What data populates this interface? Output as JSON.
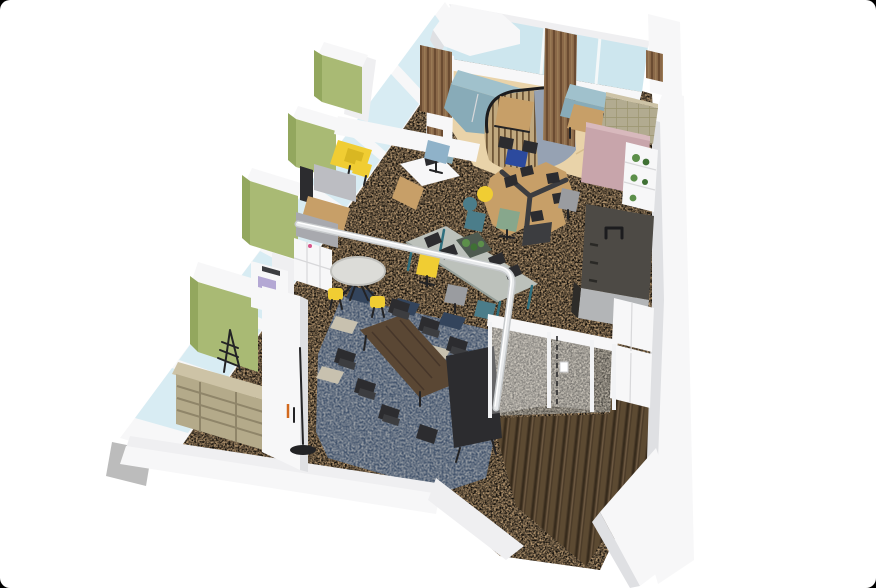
{
  "meta": {
    "title": "3D isometric office floor plan rendering",
    "type": "architectural-render",
    "canvas": {
      "width": 876,
      "height": 588,
      "corner_radius": 10,
      "background": "#ffffff",
      "corner_background": "#000000"
    },
    "description": "Bird's-eye isometric render of an office: window walls on two sides, lounge with curved slatted pod, open office desks on tan carpet, meeting area on navy carpet, glass entry vestibule and dark-wood entrance corridor."
  },
  "palette": {
    "corner_black": "#000000",
    "page_white": "#ffffff",
    "wall_white": "#f7f7f8",
    "wall_light": "#efeff1",
    "wall_shade": "#dfe0e3",
    "wall_dark": "#c9cacd",
    "wall_gray_cap": "#bcbcbc",
    "glass_blue": "#d8ecf3",
    "glass_blue_deep": "#cde6ee",
    "carpet_tan": "#b2946e",
    "carpet_speckle": "#5e4a33",
    "wood_floor_light": "#e9d3a9",
    "navy_carpet": "#42536c",
    "tile_beige": "#c8c1af",
    "tile_navy": "#33445c",
    "stone_floor": "#b7b0a3",
    "dark_wood_floor": "#4c3c29",
    "cabinet_green": "#a9ba74",
    "cabinet_green_shade": "#93a75e",
    "accent_yellow": "#f0cd33",
    "booth_gray": "#bcbdc2",
    "desk_wood": "#c79f68",
    "desk_wood_shade": "#a87f4e",
    "sofa_teal": "#a0c1cc",
    "sofa_teal_shade": "#88abb8",
    "pod_blue_gray": "#96a2b3",
    "pod_slat_wood": "#c0a87e",
    "slat_wood_brown": "#8a6848",
    "partition_pink": "#c8a5ab",
    "tufted_olive": "#b2ab90",
    "kitchen_dark": "#4d4a45",
    "kitchen_gray": "#b3b5b7",
    "meeting_table_walnut": "#5a4734",
    "chair_black": "#2c2c2f",
    "chair_gray": "#9a9ca0",
    "chair_sage": "#87a78c",
    "chair_light_blue": "#8fb2c9",
    "chair_navy_blue": "#2c4a9e",
    "chair_teal": "#4b7d8a",
    "plant_green": "#5c8f4a",
    "shelf_beige": "#cdc3a6",
    "copier_lavender": "#b4a8d4",
    "standing_table_concrete": "#bcc1bb",
    "table_leg_teal": "#2f6f7e",
    "rail_white": "#e8eaec"
  },
  "regions": [
    {
      "name": "window-wall-left",
      "label": "Floor-to-ceiling window wall, north-west side"
    },
    {
      "name": "window-wall-top",
      "label": "Window wall, north-east side"
    },
    {
      "name": "lounge",
      "label": "Lounge with teal sofas, wood-slat screens and herringbone wood floor"
    },
    {
      "name": "curved-pod",
      "label": "Curved wood-slat privacy pod with high table"
    },
    {
      "name": "tufted-booth",
      "label": "Tufted high-back booth"
    },
    {
      "name": "pink-partition",
      "label": "Dusty-pink acoustic partition"
    },
    {
      "name": "plant-shelf",
      "label": "White open shelf with plants"
    },
    {
      "name": "kitchen-island",
      "label": "Dark kitchen island with faucet"
    },
    {
      "name": "open-office",
      "label": "Open office area on tan speckled carpet"
    },
    {
      "name": "desk-cluster",
      "label": "Pinwheel cluster of six desks with monitors and task chairs"
    },
    {
      "name": "standing-table",
      "label": "Long concrete-look high table with planter, monitors and mixed chairs"
    },
    {
      "name": "corner-desk",
      "label": "White and wood corner desk with light-blue chair"
    },
    {
      "name": "round-table",
      "label": "Round white table with yellow stools"
    },
    {
      "name": "green-cabinets",
      "label": "Olive-green storage cabinets along window wall"
    },
    {
      "name": "yellow-counter",
      "label": "Yellow counter with two yellow chairs"
    },
    {
      "name": "booth-seating",
      "label": "Gray high-back booth sofas with wood table and monitor"
    },
    {
      "name": "lockers",
      "label": "White personal lockers"
    },
    {
      "name": "copier",
      "label": "Multifunction copier"
    },
    {
      "name": "bookshelf",
      "label": "Beige open bookshelf"
    },
    {
      "name": "coat-rack",
      "label": "Black coat rack"
    },
    {
      "name": "meeting-area",
      "label": "Meeting area on navy carpet with walnut table, black chairs and display"
    },
    {
      "name": "floor-lamp",
      "label": "Black floor lamp"
    },
    {
      "name": "glass-balustrade",
      "label": "White-framed glass partition rail"
    },
    {
      "name": "vestibule",
      "label": "Glass-walled entry vestibule with sliding door and stone floor"
    },
    {
      "name": "entrance-corridor",
      "label": "Entrance corridor with dark wood plank flooring"
    },
    {
      "name": "storage-cabinets-entry",
      "label": "White storage cabinets at entrance"
    },
    {
      "name": "exterior-walls",
      "label": "White exterior walls"
    }
  ]
}
